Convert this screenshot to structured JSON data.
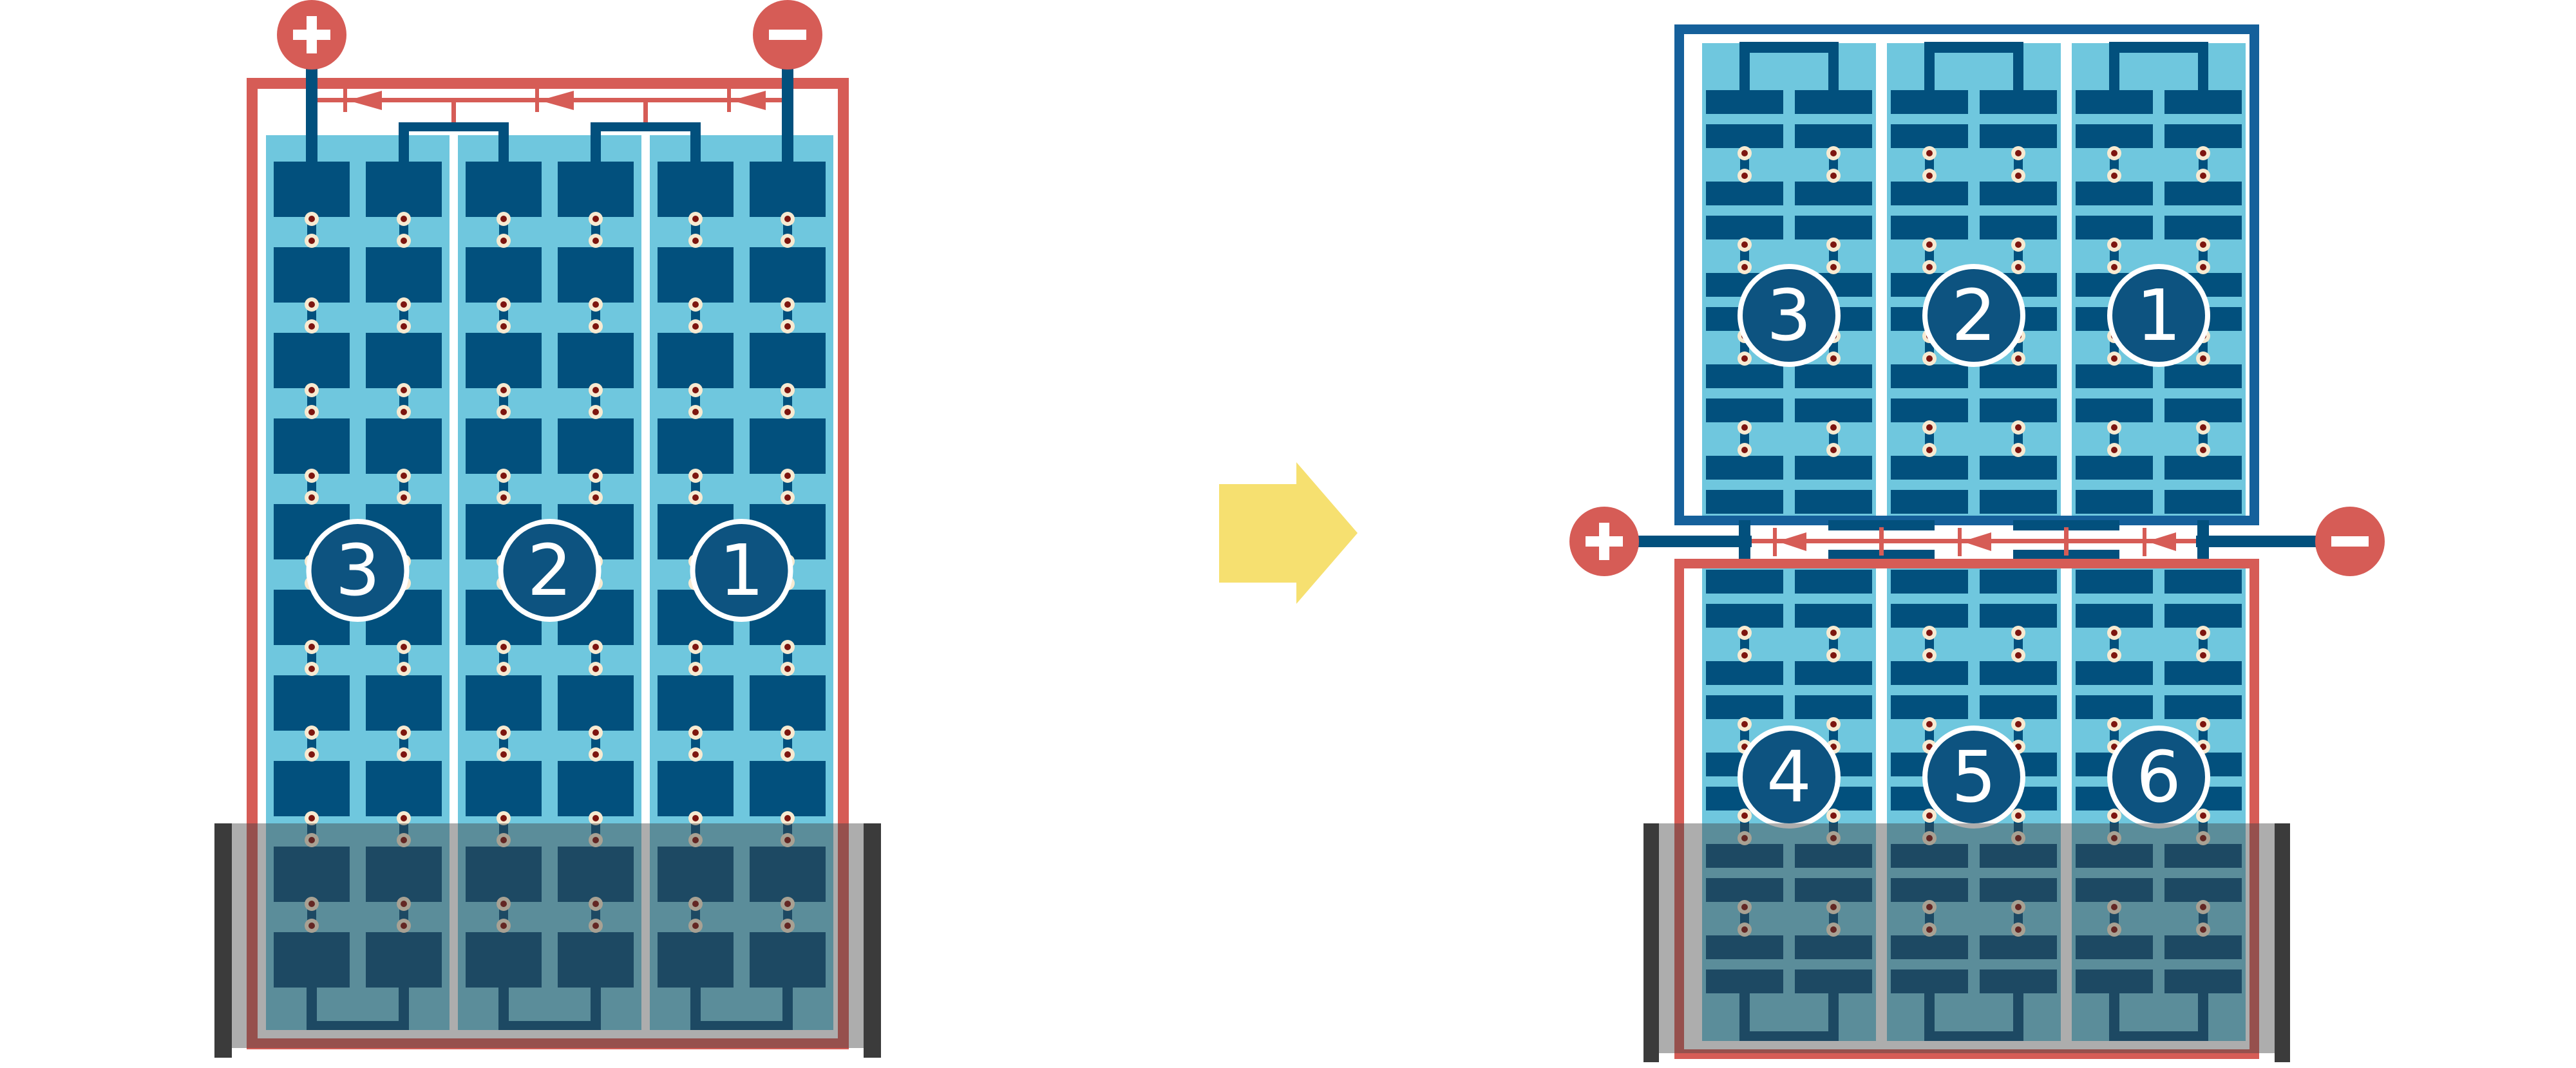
{
  "diagram": {
    "kind": "solar-module-bypass-diode-rewiring",
    "left_module": {
      "strings": [
        {
          "label": "3"
        },
        {
          "label": "2"
        },
        {
          "label": "1"
        }
      ],
      "terminals": [
        {
          "symbol": "+",
          "side": "left"
        },
        {
          "symbol": "-",
          "side": "right"
        }
      ],
      "diode_count": 3,
      "flooded": true
    },
    "arrow": {
      "direction": "right"
    },
    "right_stack": {
      "top_module": {
        "strings": [
          {
            "label": "3"
          },
          {
            "label": "2"
          },
          {
            "label": "1"
          }
        ],
        "flooded": false
      },
      "bottom_module": {
        "strings": [
          {
            "label": "4"
          },
          {
            "label": "5"
          },
          {
            "label": "6"
          }
        ],
        "flooded": true
      },
      "terminals": [
        {
          "symbol": "+",
          "side": "left"
        },
        {
          "symbol": "-",
          "side": "right"
        }
      ],
      "diode_count": 3
    }
  },
  "colors": {
    "red": "#d65c56",
    "cell_blue": "#02507d",
    "panel_blue": "#6fc7de",
    "module_frame_blue": "#15609b",
    "circle_fill": "#0d5380",
    "circle_ring": "#ffffff",
    "dot_ring": "#f7ead1",
    "dot_core": "#7d150f",
    "water_gray": "rgba(64,64,64,0.43)",
    "water_bar": "#3b3b3b",
    "arrow_yellow": "#f6e070",
    "background": "#ffffff",
    "symbol_white": "#ffffff"
  }
}
